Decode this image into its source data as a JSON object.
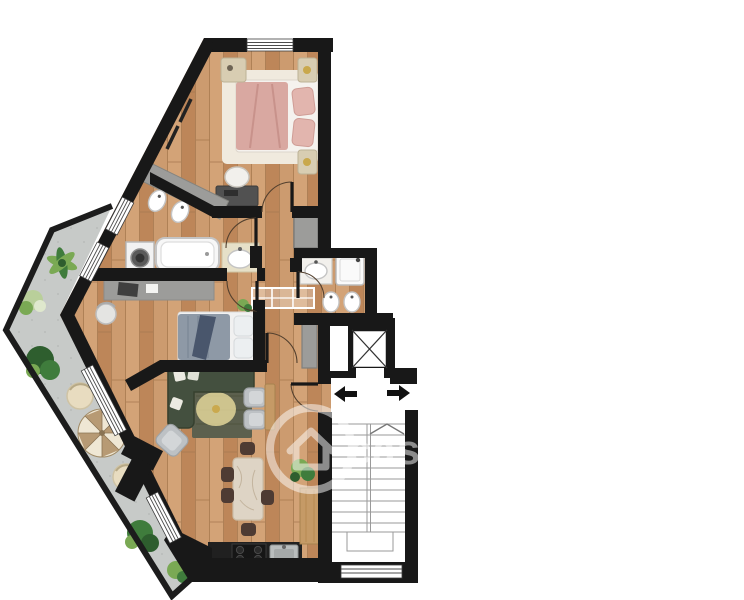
{
  "watermark": {
    "text": "casa.it"
  },
  "icons": {
    "entrance_arrow": "arrow-left",
    "stairs_arrow": "arrow-right",
    "stairs_direction": "chevron-up",
    "elevator": "x-box",
    "watermark_logo": "house-in-circle"
  },
  "colors": {
    "wall": "#181818",
    "fence": "#1c1c1c",
    "wood": "#c9976c",
    "wood_light": "#d3a377",
    "wood_mid": "#cc9b6f",
    "wood_dark": "#bd8659",
    "wood_line": "#a87a50",
    "terrace": "#c7cac8",
    "terrace_dot": "#b4b7b6",
    "rug_bed1": "#f0eade",
    "bed1": "#d9a8a1",
    "bed1_fold": "#c8928b",
    "pillow1": "#e2b5ae",
    "nightstand": "#d8cdb2",
    "lamp_gold": "#c9a84c",
    "counter_gray": "#9c9c9a",
    "desk_dark": "#515151",
    "fixture": "#ffffff",
    "fixture_edge": "#c4c4c4",
    "steel": "#b9bdbd",
    "bed2": "#8e99a6",
    "bed2_throw": "#49566c",
    "pillow2": "#eceff1",
    "sofa": "#44503f",
    "rug_living": "#5c604e",
    "glow": "#f4e6a4",
    "armchair": "#bdc1c4",
    "bar_wood": "#c59a66",
    "marble": "#ded4c5",
    "marble_vein": "#c3b49e",
    "chair_brown": "#4e3b33",
    "kitchen": "#202020",
    "plant": "#3f7c3c",
    "plant_dark": "#2e5e2e",
    "plant_light": "#7aa954",
    "plant_pale": "#b9cf9a",
    "cream": "#e8dcc0",
    "umbrella_a": "#b79a74",
    "umbrella_b": "#efe7d4",
    "line": "#9a9a9a",
    "arrow": "#111111",
    "watermark": "#ffffff"
  }
}
